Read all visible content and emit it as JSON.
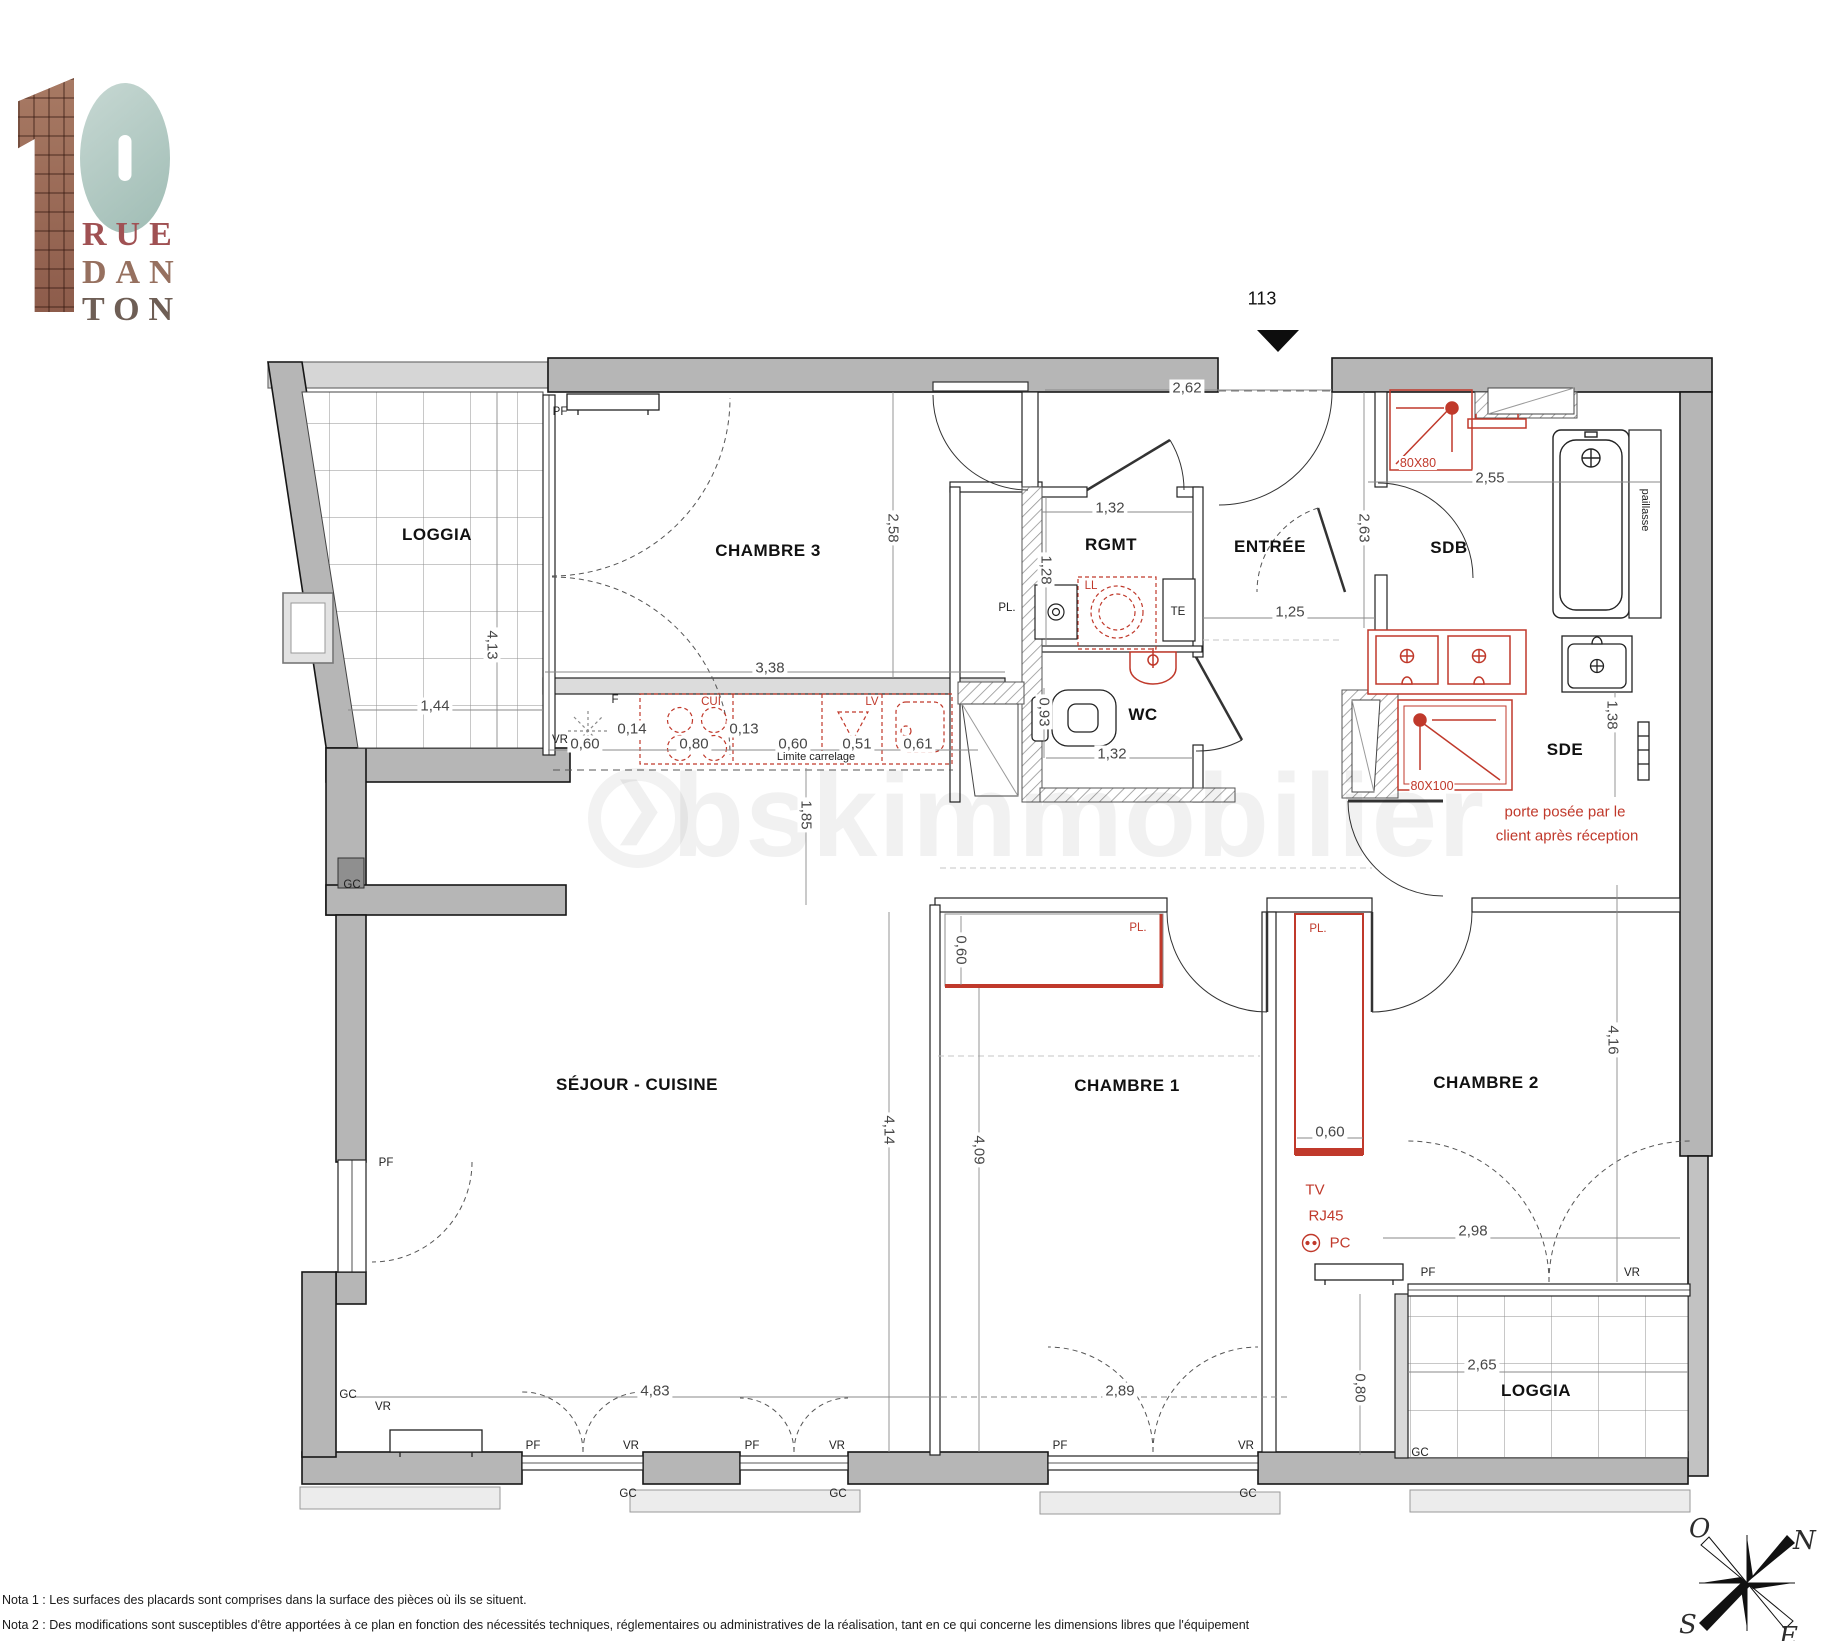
{
  "logo": {
    "digit1": "1",
    "digit0": "0",
    "line1": "RUE",
    "line2": "DAN",
    "line3": "TON"
  },
  "unit": {
    "number": "113"
  },
  "watermark": {
    "text": "bskimmobilier",
    "arrow": "❯"
  },
  "rooms": {
    "loggia_top": "LOGGIA",
    "chambre3": "CHAMBRE 3",
    "rgmt": "RGMT",
    "entree": "ENTRÉE",
    "sdb": "SDB",
    "wc": "WC",
    "sde": "SDE",
    "sejour": "SÉJOUR - CUISINE",
    "chambre1": "CHAMBRE 1",
    "chambre2": "CHAMBRE 2",
    "loggia_bottom": "LOGGIA"
  },
  "dims": {
    "top_entree": "2,62",
    "chambre3_w": "3,38",
    "loggia_w": "1,44",
    "loggia_h": "4,13",
    "chambre3_h": "2,58",
    "rgmt_w": "1,32",
    "rgmt_h": "1,28",
    "entree_w": "1,25",
    "sdb_w": "2,55",
    "sdb_h": "2,63",
    "wc_h": "0,93",
    "wc_w": "1,32",
    "sde_h": "1,38",
    "k1": "0,60",
    "k2": "0,14",
    "k3": "0,80",
    "k4": "0,13",
    "k5": "0,60",
    "k6": "0,51",
    "k7": "0,61",
    "kitchen_d": "1,85",
    "sejour_h": "4,14",
    "chambre1_h": "4,09",
    "pl1_d": "0,60",
    "pl2_w": "0,60",
    "chambre2_h": "4,16",
    "chambre2_w": "2,98",
    "loggia2_w": "2,65",
    "loggia2_d": "0,80",
    "sejour_w": "4,83",
    "chambre1_w": "2,89"
  },
  "annotations": {
    "shower_sdb": "80X80",
    "shower_sde": "80X100",
    "ll": "LL",
    "te": "TE",
    "f": "F",
    "cui": "CUI",
    "lv": "LV",
    "pl": "PL.",
    "tv": "TV",
    "rj45": "RJ45",
    "pc": "PC",
    "porte1": "porte posée par le",
    "porte2": "client après réception",
    "limite": "Limite carrelage",
    "paillasse": "paillasse"
  },
  "openings": {
    "pf": "PF",
    "vr": "VR",
    "gc": "GC"
  },
  "compass": {
    "n": "N",
    "s": "S",
    "e": "E",
    "o": "O"
  },
  "notes": {
    "nota1": "Nota 1 : Les surfaces des placards sont comprises dans la surface des pièces où ils se situent.",
    "nota2": "Nota 2 : Des modifications sont susceptibles d'être apportées à ce plan en fonction des nécessités techniques, réglementaires ou administratives de la réalisation, tant en ce qui concerne les dimensions libres que l'équipement"
  }
}
